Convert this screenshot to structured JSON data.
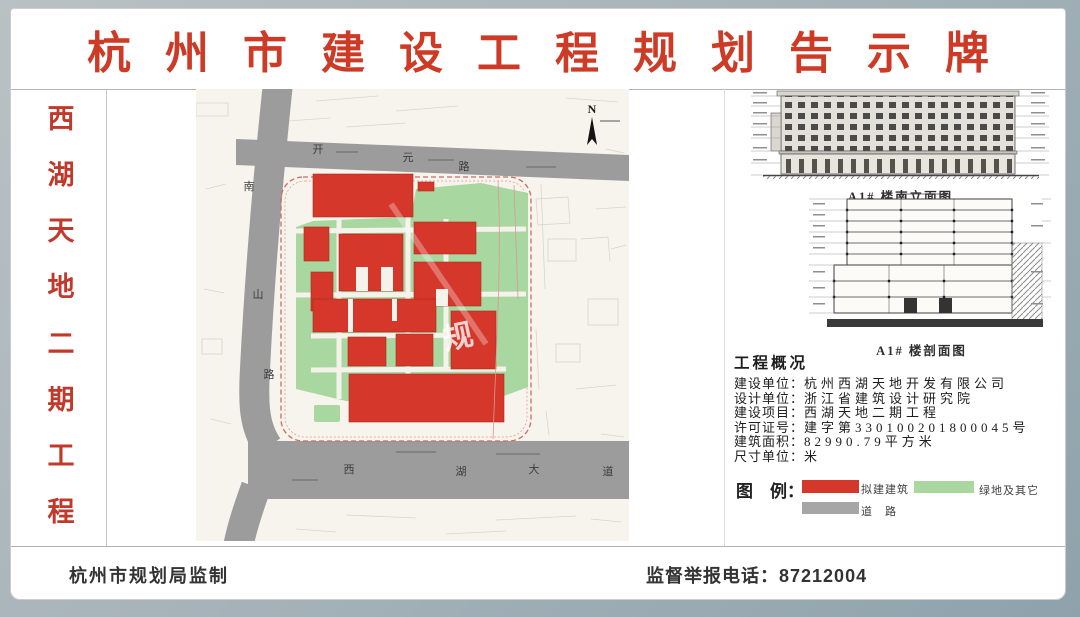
{
  "board": {
    "title": "杭州市建设工程规划告示牌"
  },
  "sidebar": {
    "project_name": "西湖天地二期工程",
    "chars": [
      "西",
      "湖",
      "天",
      "地",
      "二",
      "期",
      "工",
      "程"
    ]
  },
  "map": {
    "north_label": "N",
    "roads": {
      "top": "开元路",
      "left": "南山路",
      "bottom": "西湖大道"
    },
    "road_chars": {
      "top": [
        "开",
        "元",
        "路"
      ],
      "left": [
        "南",
        "山",
        "路"
      ],
      "bottom": [
        "西",
        "湖",
        "大",
        "道"
      ]
    },
    "watermark": "规"
  },
  "drawings": {
    "elevation_caption": "A1# 楼南立面图",
    "section_caption": "A1# 楼剖面图"
  },
  "overview": {
    "heading": "工程概况",
    "rows": [
      {
        "label": "建设单位：",
        "value": "杭州西湖天地开发有限公司"
      },
      {
        "label": "设计单位：",
        "value": "浙江省建筑设计研究院"
      },
      {
        "label": "建设项目：",
        "value": "西湖天地二期工程"
      },
      {
        "label": "许可证号：",
        "value": "建字第330100201800045号"
      },
      {
        "label": "建筑面积：",
        "value": "82990.79平方米"
      },
      {
        "label": "尺寸单位：",
        "value": "米"
      }
    ]
  },
  "legend": {
    "heading": "图　例：",
    "items": [
      {
        "label": "拟建建筑",
        "color": "#d5372a"
      },
      {
        "label": "绿地及其它",
        "color": "#a8d79f"
      },
      {
        "label": "道　路",
        "color": "#a6a6a6"
      }
    ]
  },
  "footer": {
    "issuer": "杭州市规划局监制",
    "hotline_label": "监督举报电话：",
    "hotline_number": "87212004"
  },
  "colors": {
    "title_red": "#cd3a25",
    "building_red": "#d5372a",
    "green": "#a8d79f",
    "road_gray": "#9c9c9c",
    "boundary_red": "#d06a5f",
    "map_background": "#f7f3ed"
  }
}
